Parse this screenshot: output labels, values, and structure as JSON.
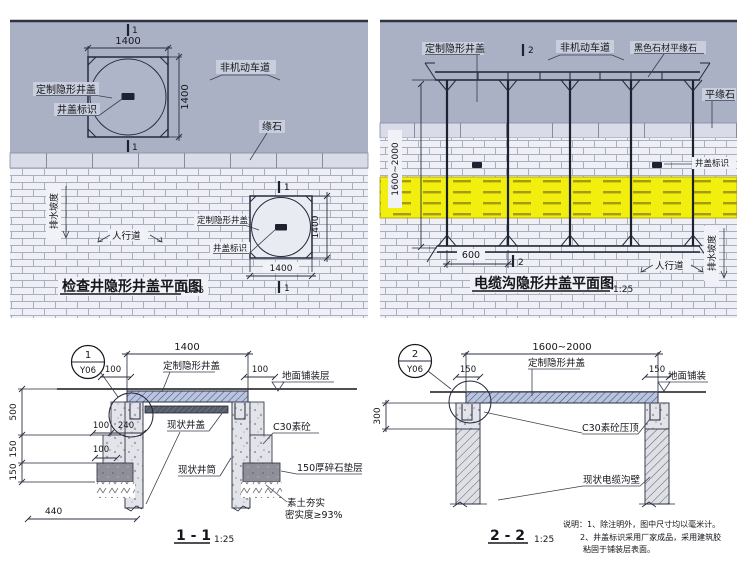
{
  "colors": {
    "road_surface": "#aab1c5",
    "sidewalk_brick": "#eef0f6",
    "tactile_yellow": "#f2ee0d",
    "cover_slab_blue": "#b9c5e0",
    "gravel_gray": "#8e8f98",
    "line_dark": "#23283a"
  },
  "plan_left": {
    "title": "检查井隐形井盖平面图",
    "scale": "1:25",
    "section_no": "1",
    "dim_size": "1400",
    "label_cover": "定制隐形井盖",
    "label_mark": "井盖标识",
    "label_lane": "非机动车道",
    "label_curb": "缘石",
    "label_slope": "排水坡度",
    "label_walk": "人行道"
  },
  "plan_right": {
    "title": "电缆沟隐形井盖平面图",
    "scale": "1:25",
    "section_no": "2",
    "dim_depth": "1600~2000",
    "dim_600": "600",
    "label_cover": "定制隐形井盖",
    "label_lane": "非机动车道",
    "label_black_curb": "黑色石材平缘石",
    "label_flat_curb": "平缘石",
    "label_mark": "井盖标识",
    "label_walk": "人行道",
    "label_slope": "排水坡度"
  },
  "section_1": {
    "title": "1 - 1",
    "scale": "1:25",
    "callout_no": "1",
    "callout_sheet": "Y06",
    "dim_w": "1400",
    "dim_100": "100",
    "dim_240": "240",
    "dim_500": "500",
    "dim_150": "150",
    "dim_440": "440",
    "label_cover": "定制隐形井盖",
    "label_pave": "地面铺装层",
    "label_old_cover": "现状井盖",
    "label_c30": "C30素砼",
    "label_shaft": "现状井筒",
    "label_gravel": "150厚碎石垫层",
    "label_soil1": "素土夯实",
    "label_soil2": "密实度≥93%"
  },
  "section_2": {
    "title": "2 - 2",
    "scale": "1:25",
    "callout_no": "2",
    "callout_sheet": "Y06",
    "dim_w": "1600~2000",
    "dim_150": "150",
    "dim_300": "300",
    "label_cover": "定制隐形井盖",
    "label_pave": "地面铺装",
    "label_c30cap": "C30素砼压顶",
    "label_wall": "现状电缆沟壁"
  },
  "notes": {
    "n1": "说明：1、除注明外，图中尺寸均以毫米计。",
    "n2": "2、井盖标识采用厂家成品，采用建筑胶",
    "n3": "粘固于铺装层表面。"
  }
}
